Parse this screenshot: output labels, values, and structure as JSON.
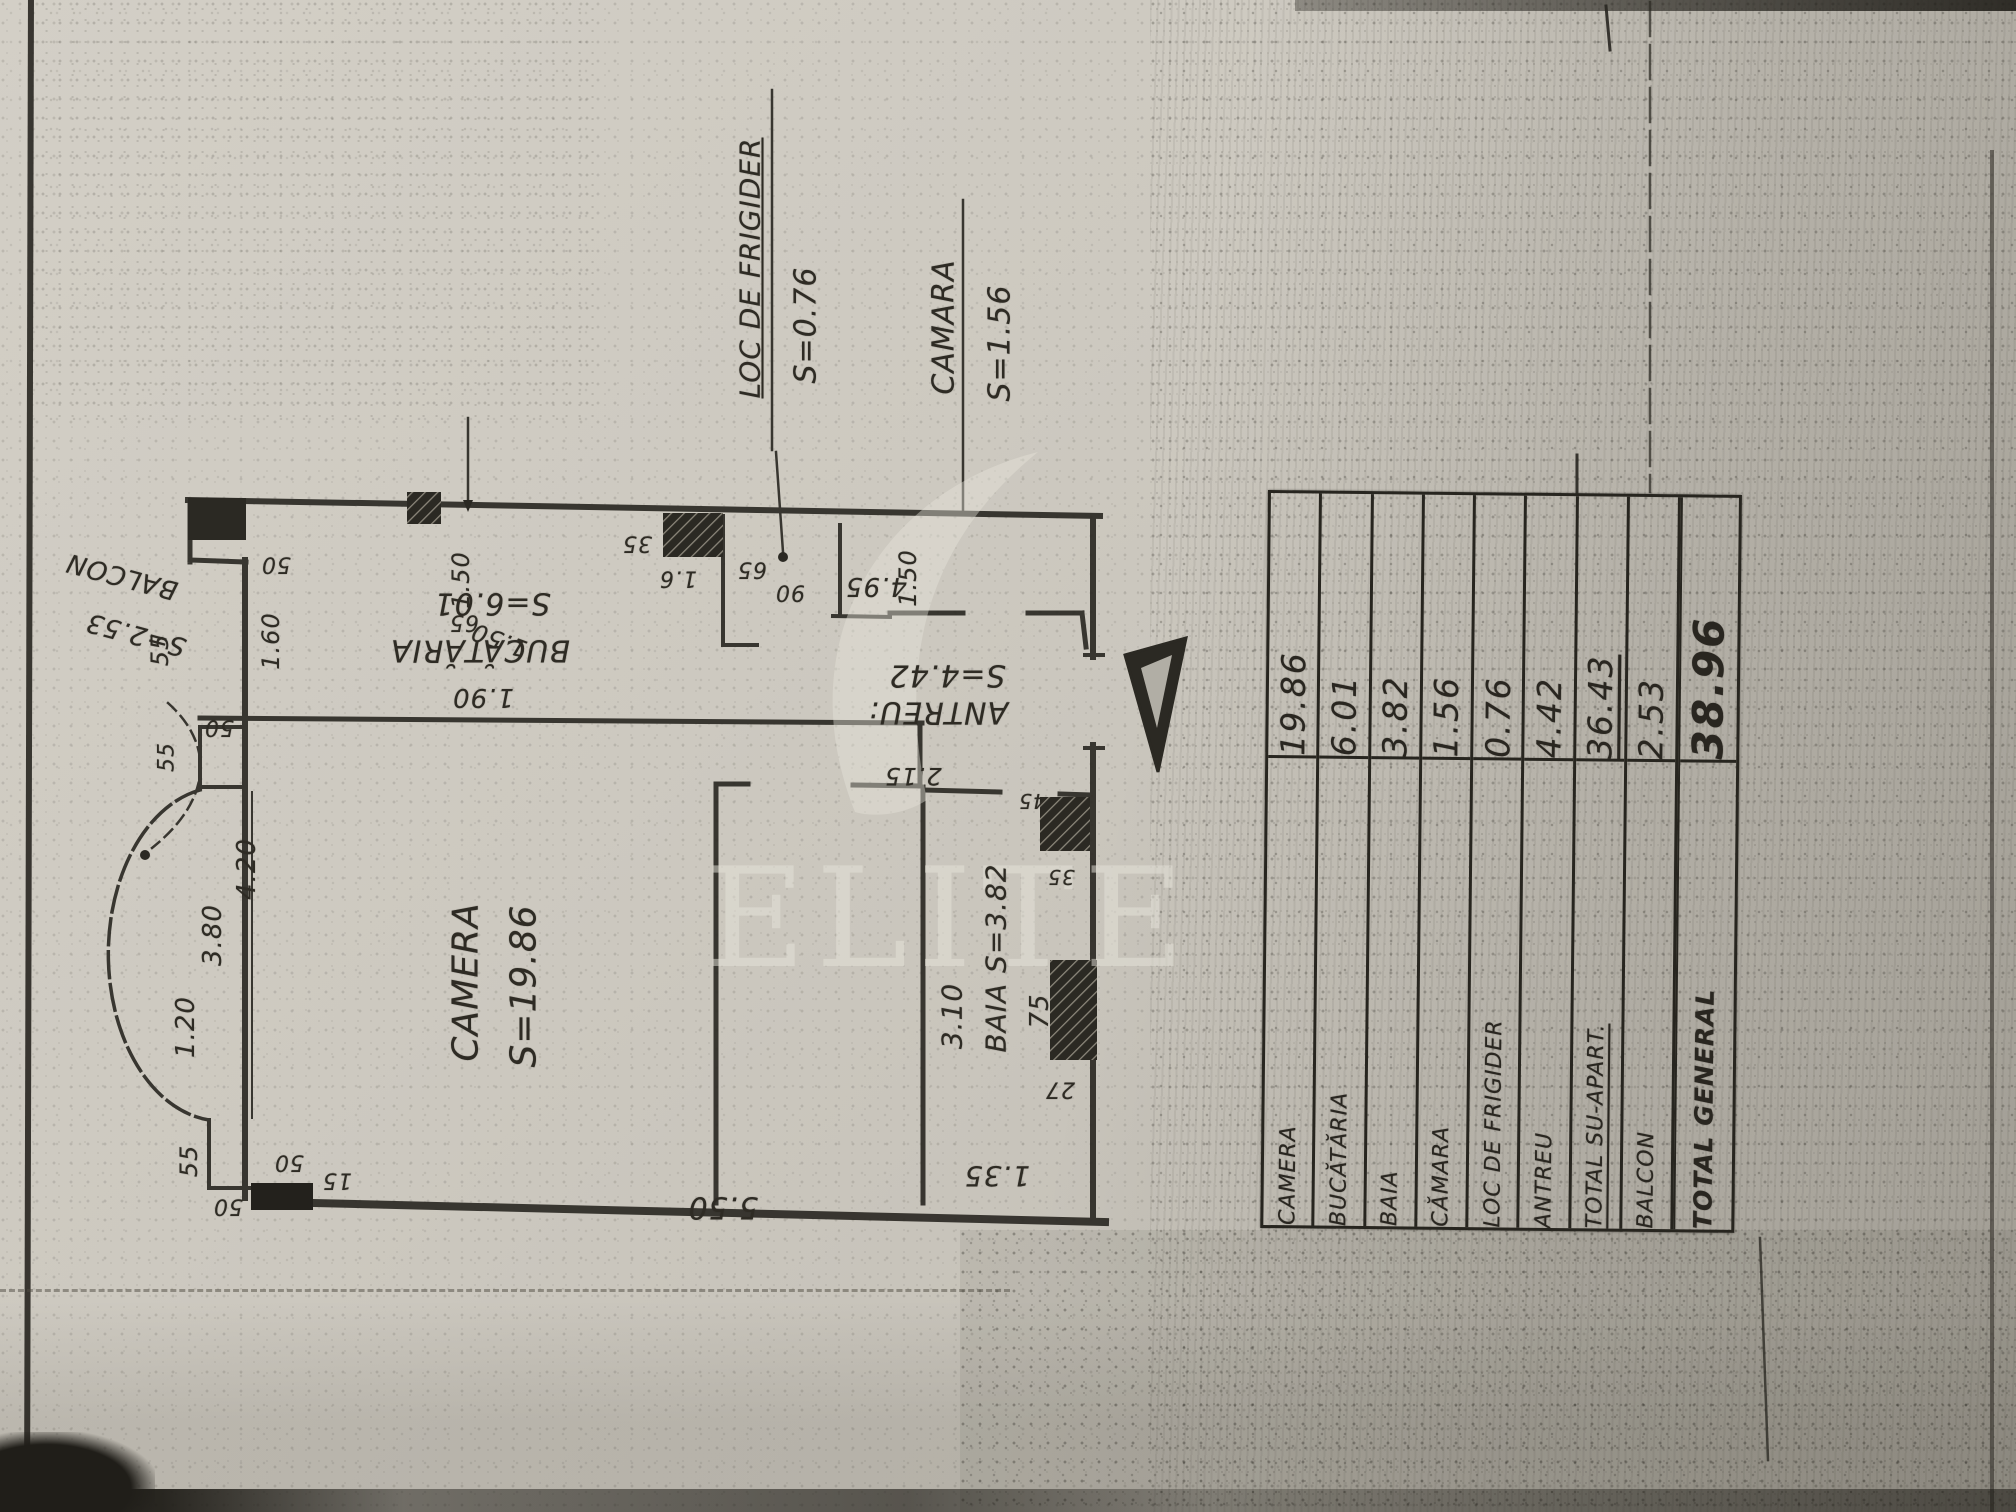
{
  "watermark": {
    "brand": "ELITE"
  },
  "plan": {
    "rooms": [
      {
        "name": "CAMERA",
        "area": "S=19.86"
      },
      {
        "name": "BUCĂTĂRIA",
        "area": "S=6.01"
      },
      {
        "name": "BAIA",
        "area": "S=3.82"
      },
      {
        "name": "CĂMARA",
        "area": "S=1.56"
      },
      {
        "name": "LOC DE FRIGIDER",
        "area": "S=0.76"
      },
      {
        "name": "ANTREU",
        "area": "S=4.42"
      },
      {
        "name": "BALCON",
        "area": "S=2.53"
      }
    ],
    "labels": [
      {
        "t": "LOC DE FRIGIDER",
        "x": 750,
        "y": 268,
        "r": -90,
        "fs": 28,
        "u": true
      },
      {
        "t": "S=0.76",
        "x": 806,
        "y": 325,
        "r": -90,
        "fs": 30
      },
      {
        "t": "CAMARA",
        "x": 944,
        "y": 327,
        "r": -90,
        "fs": 30
      },
      {
        "t": "S=1.56",
        "x": 1000,
        "y": 343,
        "r": -90,
        "fs": 30
      },
      {
        "t": "BALCON",
        "x": 122,
        "y": 576,
        "r": 195,
        "fs": 26
      },
      {
        "t": "S=2.53",
        "x": 136,
        "y": 634,
        "r": 195,
        "fs": 26
      },
      {
        "t": "S=6.01",
        "x": 492,
        "y": 603,
        "r": 180,
        "fs": 30
      },
      {
        "t": "BUCĂTĂRIA",
        "x": 480,
        "y": 650,
        "r": 180,
        "fs": 30
      },
      {
        "t": "1.90",
        "x": 483,
        "y": 697,
        "r": 180,
        "fs": 26
      },
      {
        "t": "CAMERA",
        "x": 466,
        "y": 982,
        "r": -90,
        "fs": 36
      },
      {
        "t": "S=19.86",
        "x": 524,
        "y": 986,
        "r": -90,
        "fs": 36
      },
      {
        "t": "S=4.42",
        "x": 947,
        "y": 675,
        "r": 180,
        "fs": 30
      },
      {
        "t": "ANTREU:",
        "x": 938,
        "y": 712,
        "r": 180,
        "fs": 30
      },
      {
        "t": "2.15",
        "x": 913,
        "y": 776,
        "r": 180,
        "fs": 24
      },
      {
        "t": "BAIA S=3.82",
        "x": 996,
        "y": 958,
        "r": -90,
        "fs": 28
      },
      {
        "t": "3.10",
        "x": 952,
        "y": 1016,
        "r": -90,
        "fs": 28
      },
      {
        "t": "75",
        "x": 1040,
        "y": 1011,
        "r": -90,
        "fs": 26
      },
      {
        "t": "27",
        "x": 1060,
        "y": 1089,
        "r": 180,
        "fs": 22
      },
      {
        "t": "1.35",
        "x": 997,
        "y": 1176,
        "r": 180,
        "fs": 28
      },
      {
        "t": "5.50",
        "x": 723,
        "y": 1207,
        "r": 180,
        "fs": 30
      },
      {
        "t": "35",
        "x": 637,
        "y": 543,
        "r": 180,
        "fs": 22
      },
      {
        "t": "1.6",
        "x": 678,
        "y": 578,
        "r": 180,
        "fs": 22
      },
      {
        "t": "65",
        "x": 752,
        "y": 569,
        "r": 180,
        "fs": 22
      },
      {
        "t": "90",
        "x": 790,
        "y": 592,
        "r": 180,
        "fs": 22
      },
      {
        "t": "4.95",
        "x": 876,
        "y": 586,
        "r": 180,
        "fs": 26
      },
      {
        "t": "1.50",
        "x": 908,
        "y": 578,
        "r": -90,
        "fs": 24
      },
      {
        "t": "1.50",
        "x": 461,
        "y": 580,
        "r": -90,
        "fs": 24
      },
      {
        "t": "65",
        "x": 464,
        "y": 622,
        "r": 180,
        "fs": 22
      },
      {
        "t": "1.50",
        "x": 499,
        "y": 640,
        "r": 200,
        "fs": 24
      },
      {
        "t": "50",
        "x": 276,
        "y": 564,
        "r": 180,
        "fs": 22
      },
      {
        "t": "1.60",
        "x": 271,
        "y": 641,
        "r": -90,
        "fs": 24
      },
      {
        "t": "55",
        "x": 160,
        "y": 650,
        "r": -90,
        "fs": 24
      },
      {
        "t": "50",
        "x": 219,
        "y": 727,
        "r": 180,
        "fs": 22
      },
      {
        "t": "55",
        "x": 167,
        "y": 757,
        "r": -90,
        "fs": 22
      },
      {
        "t": "4.20",
        "x": 247,
        "y": 869,
        "r": -90,
        "fs": 26
      },
      {
        "t": "3.80",
        "x": 213,
        "y": 935,
        "r": -90,
        "fs": 26
      },
      {
        "t": "1.20",
        "x": 186,
        "y": 1027,
        "r": -90,
        "fs": 26
      },
      {
        "t": "55",
        "x": 189,
        "y": 1161,
        "r": -90,
        "fs": 24
      },
      {
        "t": "50",
        "x": 289,
        "y": 1162,
        "r": 180,
        "fs": 22
      },
      {
        "t": "15",
        "x": 337,
        "y": 1180,
        "r": 180,
        "fs": 22
      },
      {
        "t": "50",
        "x": 228,
        "y": 1206,
        "r": 180,
        "fs": 22
      },
      {
        "t": "45",
        "x": 1032,
        "y": 801,
        "r": 180,
        "fs": 20
      },
      {
        "t": "35",
        "x": 1061,
        "y": 877,
        "r": 180,
        "fs": 20
      }
    ]
  },
  "table": {
    "rows": [
      {
        "label": "CAMERA",
        "value": "19.86"
      },
      {
        "label": "BUCĂTĂRIA",
        "value": "6.01"
      },
      {
        "label": "BAIA",
        "value": "3.82"
      },
      {
        "label": "CĂMARA",
        "value": "1.56"
      },
      {
        "label": "LOC DE FRIGIDER",
        "value": "0.76"
      },
      {
        "label": "ANTREU",
        "value": "4.42"
      },
      {
        "label": "TOTAL SU-APART.",
        "value": "36.43",
        "underline": true
      },
      {
        "label": "BALCON",
        "value": "2.53"
      },
      {
        "label": "TOTAL GENERAL",
        "value": "38.96",
        "emphasis": true
      }
    ]
  }
}
